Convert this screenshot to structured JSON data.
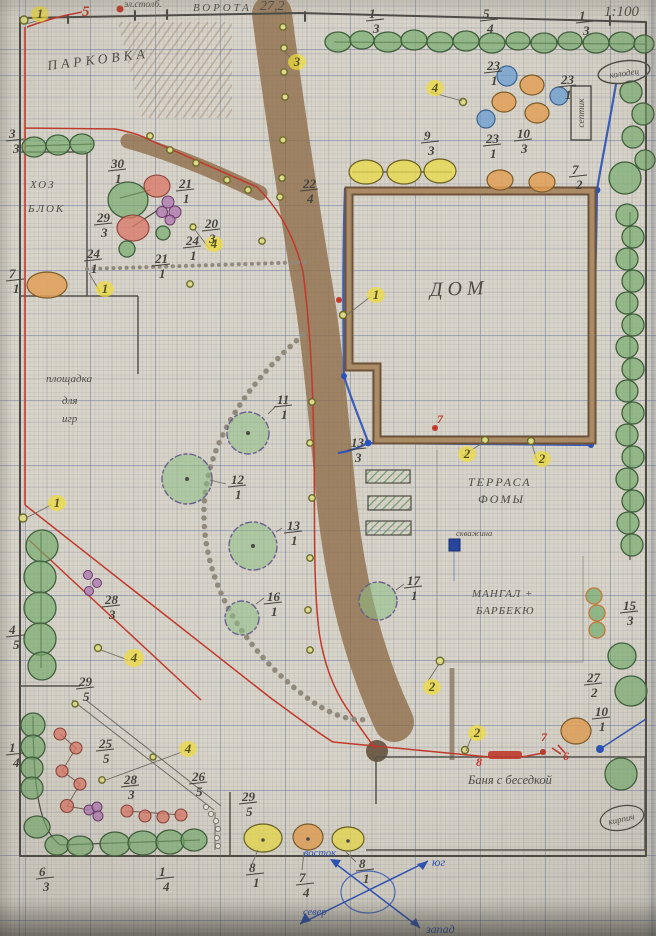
{
  "scale_label": "1:100",
  "top": {
    "power_pole": "эл.столб.",
    "gate": "ВОРОТА",
    "width": "27,2"
  },
  "areas": {
    "parking": "ПАРКОВКА",
    "utility_1": "ХОЗ",
    "utility_2": "БЛОК",
    "playground_1": "площадка",
    "playground_2": "для",
    "playground_3": "игр",
    "house": "ДОМ",
    "terrace_1": "ТЕРРАСА",
    "terrace_2": "ФОМЫ",
    "bbq_1": "МАНГАЛ +",
    "bbq_2": "БАРБЕКЮ",
    "bath": "Баня с беседкой",
    "well": "колодец",
    "septic": "септик",
    "borehole": "скважина",
    "brick": "кирпич"
  },
  "compass": {
    "e": "восток",
    "s": "юг",
    "n": "север",
    "w": "запад"
  },
  "red_marks": {
    "five": "5",
    "seven_house": "7",
    "eight": "8",
    "seven_bath": "7",
    "six": "6"
  },
  "badges": [
    "1",
    "3",
    "4",
    "4",
    "1",
    "1",
    "2",
    "2",
    "2",
    "1",
    "4",
    "4",
    "2"
  ],
  "fractions": [
    {
      "n": "3",
      "d": "3"
    },
    {
      "n": "30",
      "d": "1"
    },
    {
      "n": "21",
      "d": "1"
    },
    {
      "n": "22",
      "d": "4"
    },
    {
      "n": "29",
      "d": "3"
    },
    {
      "n": "20",
      "d": "3"
    },
    {
      "n": "24",
      "d": "1"
    },
    {
      "n": "24",
      "d": "1"
    },
    {
      "n": "21",
      "d": "1"
    },
    {
      "n": "7",
      "d": "1"
    },
    {
      "n": "1",
      "d": "3"
    },
    {
      "n": "5",
      "d": "4"
    },
    {
      "n": "1",
      "d": "3"
    },
    {
      "n": "23",
      "d": "1"
    },
    {
      "n": "23",
      "d": "1"
    },
    {
      "n": "9",
      "d": "3"
    },
    {
      "n": "23",
      "d": "1"
    },
    {
      "n": "10",
      "d": "3"
    },
    {
      "n": "7",
      "d": "2"
    },
    {
      "n": "13",
      "d": "3"
    },
    {
      "n": "11",
      "d": "1"
    },
    {
      "n": "12",
      "d": "1"
    },
    {
      "n": "13",
      "d": "1"
    },
    {
      "n": "16",
      "d": "1"
    },
    {
      "n": "4",
      "d": "5"
    },
    {
      "n": "28",
      "d": "3"
    },
    {
      "n": "29",
      "d": "5"
    },
    {
      "n": "17",
      "d": "1"
    },
    {
      "n": "15",
      "d": "3"
    },
    {
      "n": "27",
      "d": "2"
    },
    {
      "n": "10",
      "d": "1"
    },
    {
      "n": "1",
      "d": "4"
    },
    {
      "n": "25",
      "d": "5"
    },
    {
      "n": "28",
      "d": "3"
    },
    {
      "n": "26",
      "d": "5"
    },
    {
      "n": "29",
      "d": "5"
    },
    {
      "n": "6",
      "d": "3"
    },
    {
      "n": "1",
      "d": "4"
    },
    {
      "n": "8",
      "d": "1"
    },
    {
      "n": "7",
      "d": "4"
    },
    {
      "n": "8",
      "d": "1"
    }
  ],
  "colors": {
    "paper": "#d8d4ca",
    "pencil": "#4c4a44",
    "red": "#c0392b",
    "blue": "#2a52b8",
    "path_brown": "#8f6d4a",
    "green": "#74ab6c",
    "yellow": "#f0dd3c"
  }
}
